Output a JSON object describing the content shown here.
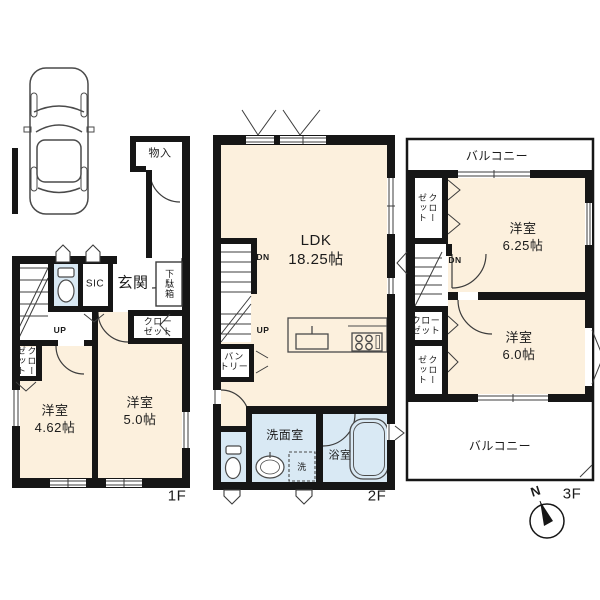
{
  "title": "3-story house floor plan",
  "colors": {
    "wall": "#161616",
    "room_fill": "#fcf0dd",
    "wet_fill": "#d9e9f4",
    "balcony_fill": "#ffffff",
    "line": "#3c3c3c"
  },
  "floors": {
    "f1": {
      "label": "1F",
      "rooms": {
        "storage": "物入",
        "sic": "SIC",
        "entrance": "玄関",
        "shoe_box": "下駄箱",
        "closet_hall": "クロー\nゼット",
        "closet_left": "クローゼット",
        "bedroom1_name": "洋室",
        "bedroom1_size": "4.62帖",
        "bedroom2_name": "洋室",
        "bedroom2_size": "5.0帖",
        "stairs_up": "UP"
      }
    },
    "f2": {
      "label": "2F",
      "rooms": {
        "ldk_name": "LDK",
        "ldk_size": "18.25帖",
        "stairs_dn": "DN",
        "stairs_up": "UP",
        "pantry": "バン\nトリー",
        "washroom": "洗面室",
        "bathroom": "浴室",
        "laundry": "洗"
      }
    },
    "f3": {
      "label": "3F",
      "rooms": {
        "balcony_top": "バルコニー",
        "balcony_bottom": "バルコニー",
        "closet_top": "クローゼット",
        "closet_mid": "クロー\nゼット",
        "closet_low": "クローゼット",
        "bedroom1_name": "洋室",
        "bedroom1_size": "6.25帖",
        "bedroom2_name": "洋室",
        "bedroom2_size": "6.0帖",
        "stairs_dn": "DN"
      }
    }
  },
  "compass": {
    "north": "N"
  }
}
